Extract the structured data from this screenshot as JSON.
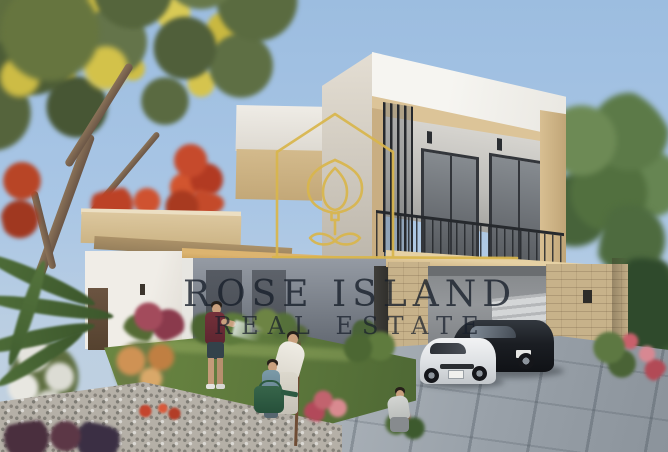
{
  "watermark": {
    "line1": "ROSE ISLAND",
    "line2": "REAL ESTATE",
    "logo_name": "rose-island-house-logo",
    "logo_color": "#D9B64C",
    "text_color": "#1A2330"
  },
  "scene": {
    "type": "architectural-render",
    "subject": "Modern two-storey villa with roof terrace, balcony, double garage and landscaped garden",
    "visible_elements": [
      "yellow-flowering tree",
      "red flowering tree",
      "white parapet roof",
      "beige-framed balcony with black railing",
      "glass balcony doors",
      "vertical louvers",
      "stone-clad garage wall",
      "white sports car",
      "black sports car",
      "paved driveway",
      "lawn and flower beds",
      "man watering lawn with hose",
      "woman and child watering a sapling",
      "green watering can",
      "gardener crouching by plants",
      "palm fronds"
    ]
  },
  "palette": {
    "sky": "#A7C4E2",
    "facade_white": "#F2F1ED",
    "facade_beige": "#D8C097",
    "wall_gray": "#8A8F98",
    "stone": "#C6B18B",
    "lawn": "#5F7C3C",
    "driveway": "#9AA3AB",
    "watermark_gold": "#D9B64C"
  }
}
